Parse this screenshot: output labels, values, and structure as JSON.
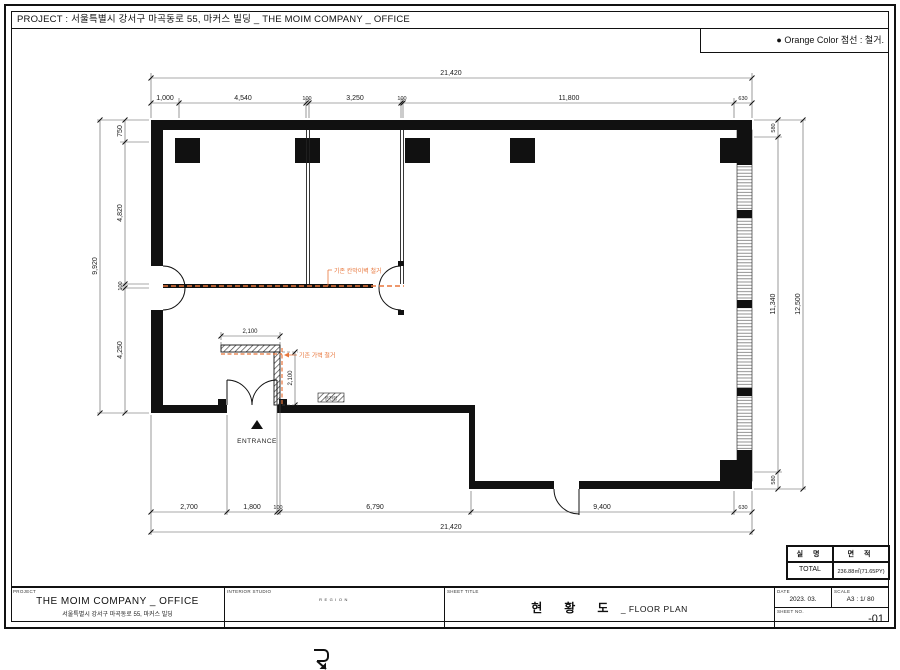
{
  "page": {
    "title": "PROJECT : 서울특별시 강서구 마곡동로 55, 마커스 빌딩 _ THE MOIM COMPANY _ OFFICE",
    "legend": "● Orange Color 점선 : 철거."
  },
  "plan": {
    "dims": {
      "top_overall": "21,420",
      "top_chain": [
        "1,000",
        "4,540",
        "100",
        "3,250",
        "100",
        "11,800",
        "630"
      ],
      "left_overall": "9,920",
      "left_chain": [
        "750",
        "4,820",
        "100",
        "4,250"
      ],
      "right_overall": "12,500",
      "right_chain": [
        "580",
        "11,340",
        "580"
      ],
      "bottom_overall": "21,420",
      "bottom_chain": [
        "2,700",
        "1,800",
        "100",
        "6,790",
        "9,400",
        "630"
      ],
      "gawall_w": "2,100",
      "gawall_h": "2,100"
    },
    "labels": {
      "entrance": "ENTRANCE",
      "panel": "분전함",
      "demo_wall": "기존 칸막이벽 철거",
      "demo_gawall": "기존 가벽 철거"
    }
  },
  "area_table": {
    "headers": [
      "실 명",
      "면 적"
    ],
    "row": {
      "name": "TOTAL",
      "area": "236.88㎡(71.65PY)"
    }
  },
  "titleblock": {
    "project_label": "PROJECT",
    "project_name": "THE MOIM COMPANY _ OFFICE",
    "project_addr": "서울특별시 강서구 마곡동로 55, 마커스 빌딩",
    "studio_label": "INTERIOR STUDIO",
    "studio_name": "REGION",
    "sheet_title_label": "SHEET TITLE",
    "sheet_title_kr": "현황도",
    "sheet_title_en": "_ FLOOR PLAN",
    "date_label": "DATE",
    "date": "2023. 03.",
    "scale_label": "SCALE",
    "scale": "A3 : 1/ 80",
    "sheetno_label": "SHEET NO.",
    "sheetno": "-01"
  },
  "colors": {
    "demo_orange": "#E8763B"
  }
}
